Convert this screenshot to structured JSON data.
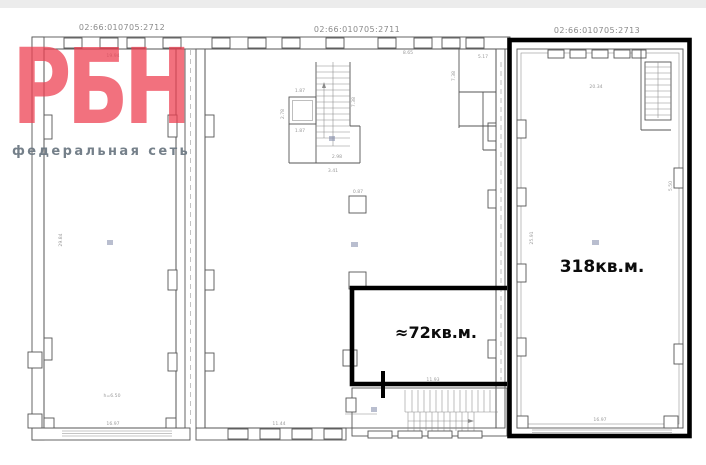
{
  "watermark": {
    "brand": "РБН",
    "tagline": "федеральная сеть"
  },
  "cadastral": {
    "left": "02:66:010705:2712",
    "middle": "02:66:010705:2711",
    "right": "02:66:010705:2713"
  },
  "areas": {
    "right_parcel": "318кв.м.",
    "middle_parcel": "≈72кв.м."
  },
  "colors": {
    "brand_red": "#ee4052",
    "tagline_gray": "#6e7a84",
    "highlight_outline": "#000000",
    "wall_line": "#555555",
    "dim_gray": "#9a9a9a",
    "cadastral_gray": "#8a8a8a",
    "room_marker_blue": "#8089a8"
  },
  "dims": [
    "19.94",
    "8.65",
    "20.34",
    "5.17",
    "1.87",
    "1.87",
    "2.78",
    "7.38",
    "2.98",
    "3.41",
    "0.87",
    "11.93",
    "11.44",
    "16.97",
    "16.97",
    "29.84",
    "25.91",
    "5.50",
    "h=6.50",
    "7.38"
  ]
}
